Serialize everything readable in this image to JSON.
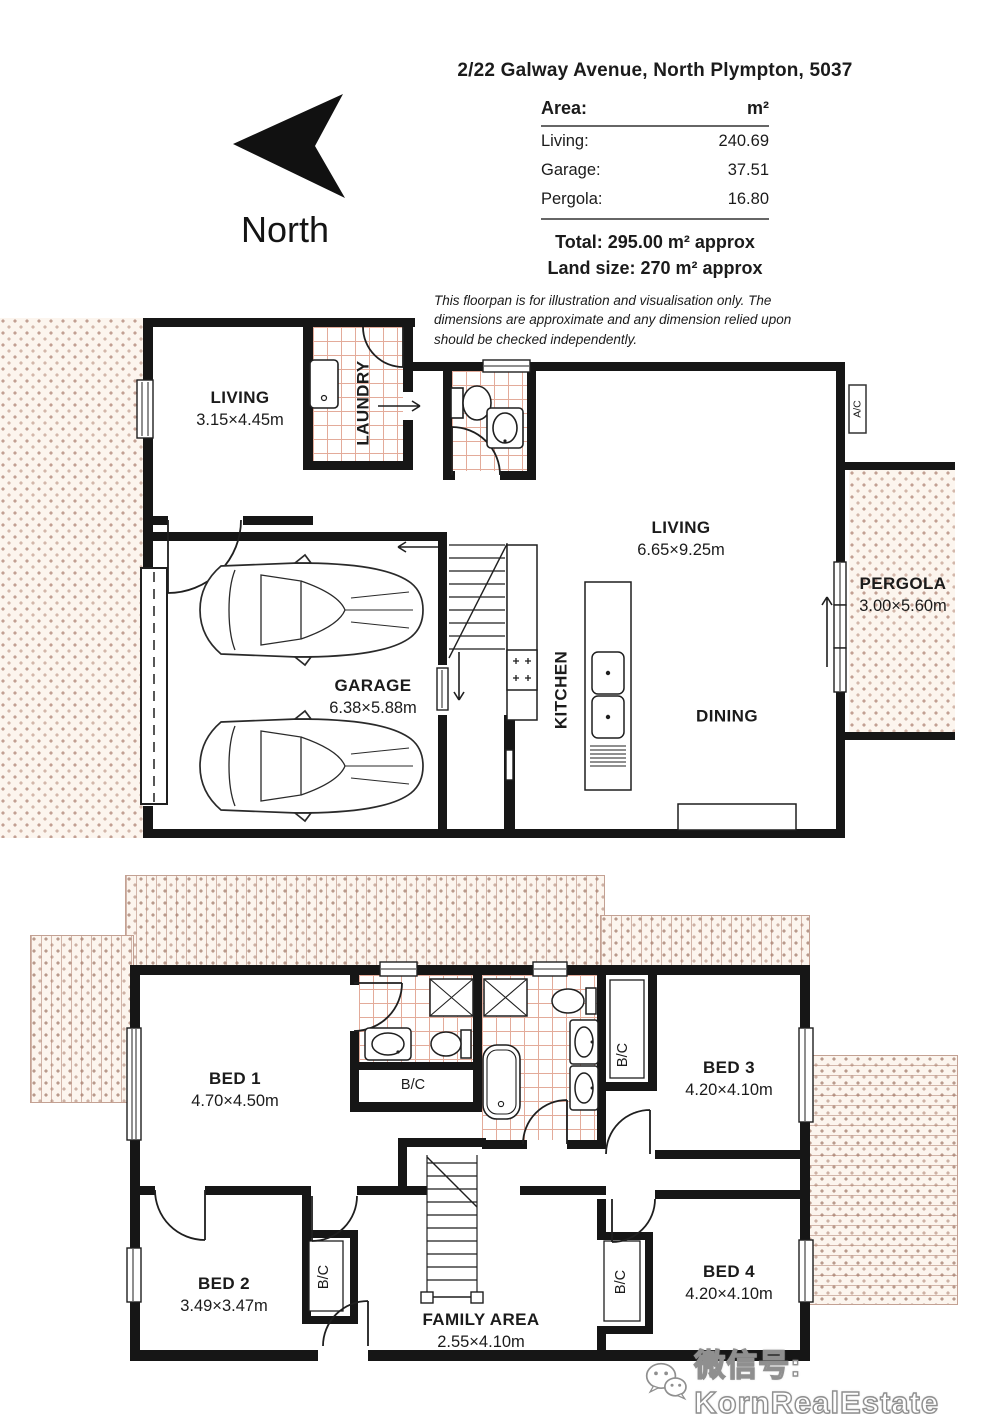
{
  "page": {
    "title": "2/22 Galway Avenue, North Plympton, 5037"
  },
  "compass": {
    "label": "North"
  },
  "area_table": {
    "header": {
      "label": "Area:",
      "unit": "m²"
    },
    "rows": [
      {
        "label": "Living:",
        "value": "240.69"
      },
      {
        "label": "Garage:",
        "value": "37.51"
      },
      {
        "label": "Pergola:",
        "value": "16.80"
      }
    ],
    "total_line": "Total: 295.00 m² approx",
    "land_line": "Land size: 270 m² approx"
  },
  "disclaimer": {
    "text": "This floorpan is for illustration and visualisation only. The dimensions are approximate and any dimension relied upon should be checked independently."
  },
  "upper_floor": {
    "living_small": {
      "name": "LIVING",
      "dims": "3.15×4.45m"
    },
    "laundry": {
      "name": "LAUNDRY"
    },
    "living_main": {
      "name": "LIVING",
      "dims": "6.65×9.25m"
    },
    "dining": {
      "name": "DINING"
    },
    "kitchen": {
      "name": "KITCHEN"
    },
    "garage": {
      "name": "GARAGE",
      "dims": "6.38×5.88m"
    },
    "pergola": {
      "name": "PERGOLA",
      "dims": "3.00×5.60m"
    },
    "ac_unit": {
      "name": "A/C"
    }
  },
  "lower_floor": {
    "bed1": {
      "name": "BED 1",
      "dims": "4.70×4.50m"
    },
    "bed2": {
      "name": "BED 2",
      "dims": "3.49×3.47m"
    },
    "bed3": {
      "name": "BED 3",
      "dims": "4.20×4.10m"
    },
    "bed4": {
      "name": "BED 4",
      "dims": "4.20×4.10m"
    },
    "family_area": {
      "name": "FAMILY AREA",
      "dims": "2.55×4.10m"
    },
    "bc_label": "B/C"
  },
  "watermark": {
    "text": "微信号: KornRealEstate"
  },
  "colors": {
    "wall": "#161616",
    "tile_line": "#e3ab9a",
    "dot": "#c2a093",
    "cream": "#fcf5ee"
  }
}
